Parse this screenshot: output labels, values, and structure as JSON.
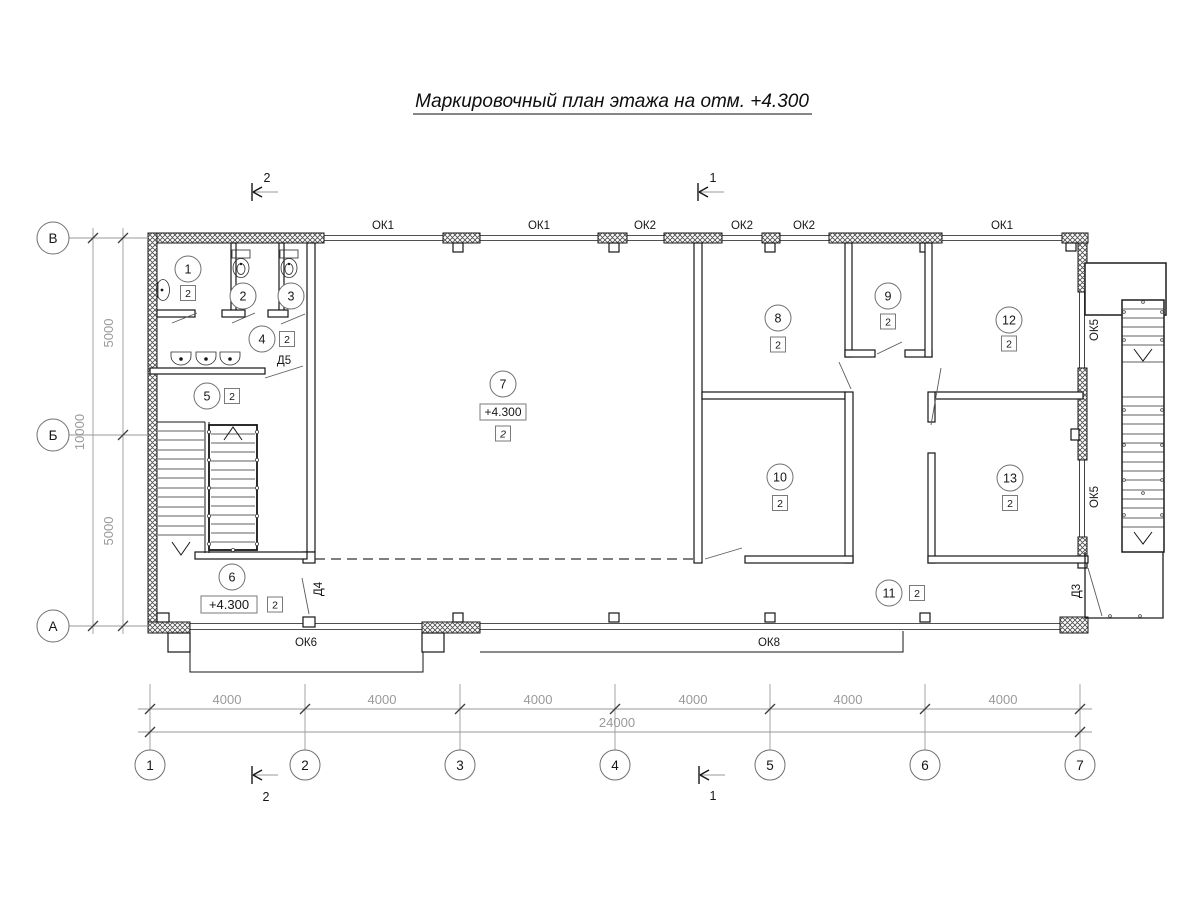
{
  "title": "Маркировочный план этажа на отм. +4.300",
  "grid": {
    "cols": [
      "1",
      "2",
      "3",
      "4",
      "5",
      "6",
      "7"
    ],
    "rows": [
      "В",
      "Б",
      "А"
    ]
  },
  "dims": {
    "bottom": [
      "4000",
      "4000",
      "4000",
      "4000",
      "4000",
      "4000"
    ],
    "bottom_total": "24000",
    "left": [
      "5000",
      "5000"
    ],
    "left_total": "10000"
  },
  "windows": {
    "top": [
      "ОК1",
      "ОК1",
      "ОК2",
      "ОК2",
      "ОК2",
      "ОК1"
    ],
    "bottom": [
      "ОК6",
      "ОК8"
    ],
    "right": [
      "ОК5",
      "ОК5"
    ]
  },
  "doors": [
    "Д5",
    "Д4",
    "Д3"
  ],
  "sections": {
    "top": [
      "2",
      "1"
    ],
    "bottom": [
      "2",
      "1"
    ]
  },
  "rooms": [
    {
      "num": "1",
      "badge": "2"
    },
    {
      "num": "2"
    },
    {
      "num": "3"
    },
    {
      "num": "4",
      "badge": "2"
    },
    {
      "num": "5",
      "badge": "2"
    },
    {
      "num": "6",
      "badge": "2",
      "elev": "+4.300"
    },
    {
      "num": "7",
      "badge": "2",
      "elev": "+4.300"
    },
    {
      "num": "8",
      "badge": "2"
    },
    {
      "num": "9",
      "badge": "2"
    },
    {
      "num": "10",
      "badge": "2"
    },
    {
      "num": "11",
      "badge": "2"
    },
    {
      "num": "12",
      "badge": "2"
    },
    {
      "num": "13",
      "badge": "2"
    }
  ],
  "colors": {
    "line": "#161616",
    "dim_text": "#9a9a9a"
  }
}
